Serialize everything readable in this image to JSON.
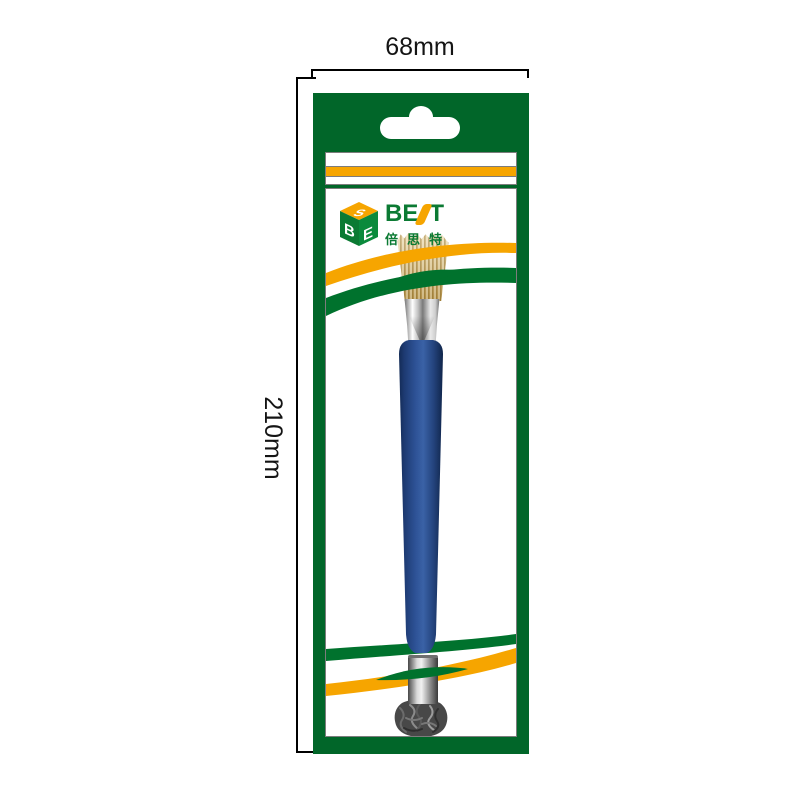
{
  "diagram": {
    "width_label": "68mm",
    "height_label": "210mm"
  },
  "packaging": {
    "brand_name": "BEST",
    "brand_prefix": "BE",
    "brand_suffix": "T",
    "brand_chinese": "倍思特",
    "cube_letters": {
      "top": "S",
      "left": "B",
      "right": "E"
    },
    "colors": {
      "card_green": "#016629",
      "logo_green": "#0b7a33",
      "swoosh_green": "#00722d",
      "accent_orange": "#f6a500",
      "handle_blue": "#2b5193",
      "bristle_tan": "#d9b869",
      "line_gray": "#7c7c7c"
    }
  }
}
